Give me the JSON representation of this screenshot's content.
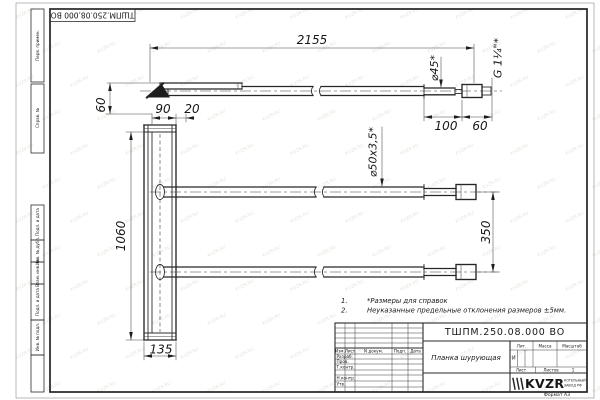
{
  "watermark": "KVZR.RU",
  "stamp": {
    "designation_reversed": "ТШПМ.250.08.000 ВО"
  },
  "margin": {
    "labels": [
      "Перв. примен.",
      "Справ. №",
      "Подп. и дата",
      "Инв. № дубл.",
      "Взам. инв. №",
      "Подп. и дата",
      "Инв. № подл."
    ]
  },
  "dims": {
    "overall_length": "2155",
    "blade_height": "60",
    "flange_width": "90",
    "lip_width": "20",
    "plank_length": "1060",
    "plank_width": "135",
    "tip_length": "100",
    "thread_length": "60",
    "tube_spacing": "350",
    "tube_section": "⌀50x3,5*",
    "tip_diameter": "⌀45*",
    "thread_spec": "G 1¼\"*"
  },
  "notes": {
    "n1_no": "1.",
    "n1_text": "*Размеры для справок",
    "n2_no": "2.",
    "n2_text": "Неуказанные предельные отклонения размеров ±5мм."
  },
  "title_block": {
    "designation": "ТШПМ.250.08.000 ВО",
    "part_name": "Планка шурующая",
    "col_izm": "Изм.",
    "col_list": "Лист",
    "col_doc": "N докум.",
    "col_podp": "Подп.",
    "col_data": "Дата",
    "row_razrab": "Разраб.",
    "row_prov": "Пров.",
    "row_tkontr": "Т.контр.",
    "row_nkontr": "Н.контр.",
    "row_utv": "Утв.",
    "lit_header": "Лит.",
    "lit_value": "И",
    "massa_header": "Масса",
    "masshtab_header": "Масштаб",
    "list_header": "Лист",
    "listov_header": "Листов",
    "listov_value": "1",
    "logo_text": "KVZR",
    "logo_line1": "КОТЕЛЬНЫЙ",
    "logo_line2": "ЗАВОД РФ",
    "format_label": "Формат А3"
  }
}
